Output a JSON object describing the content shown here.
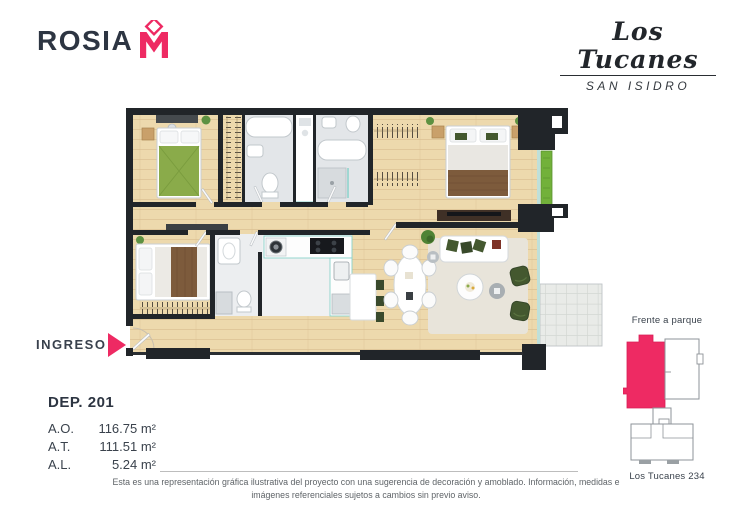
{
  "brand": {
    "name": "ROSIA",
    "monogram": "M"
  },
  "project": {
    "name": "Los Tucanes",
    "location": "SAN ISIDRO"
  },
  "entrance": {
    "label": "INGRESO"
  },
  "unit": {
    "id": "DEP. 201",
    "areas": [
      {
        "label": "A.O.",
        "value": "116.75 m²"
      },
      {
        "label": "A.T.",
        "value": "111.51 m²"
      },
      {
        "label": "A.L.",
        "value": "5.24 m²"
      }
    ]
  },
  "keyplan": {
    "top_label": "Frente a parque",
    "bottom_label": "Los Tucanes 234"
  },
  "footer": {
    "disclaimer": "Esta es una representación gráfica ilustrativa del proyecto con una sugerencia de decoración y amoblado. Información, medidas e imágenes referenciales sujetos a cambios sin previo aviso."
  },
  "colors": {
    "accent_pink": "#ee2a63",
    "navy_text": "#2d3542",
    "wall": "#212529",
    "wood_floor": "#edd9ad",
    "bath_floor": "#e3e6e9",
    "terrace_floor": "#e9ebe8",
    "plant_green": "#5d9141",
    "glass_teal": "#8ad2cb"
  }
}
